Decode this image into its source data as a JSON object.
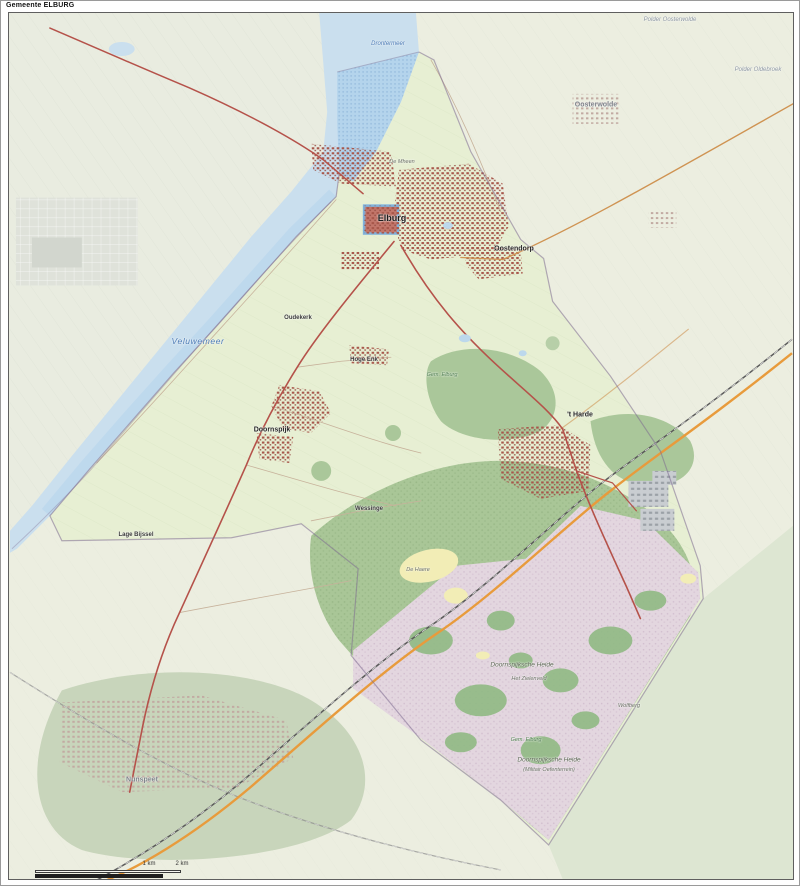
{
  "title": "Gemeente ELBURG",
  "map": {
    "labels": [
      {
        "text": "Elburg",
        "x": 390,
        "y": 216,
        "kind": "city"
      },
      {
        "text": "Oostendorp",
        "x": 512,
        "y": 247,
        "kind": "town"
      },
      {
        "text": "Doornspijk",
        "x": 270,
        "y": 428,
        "kind": "town"
      },
      {
        "text": "'t Harde",
        "x": 578,
        "y": 413,
        "kind": "town"
      },
      {
        "text": "Hoge Enk",
        "x": 362,
        "y": 358,
        "kind": "town-small"
      },
      {
        "text": "Lage Bijssel",
        "x": 134,
        "y": 533,
        "kind": "town-small"
      },
      {
        "text": "Wessinge",
        "x": 367,
        "y": 507,
        "kind": "town-small"
      },
      {
        "text": "Oudekerk",
        "x": 296,
        "y": 316,
        "kind": "town-small"
      },
      {
        "text": "Nunspeet",
        "x": 140,
        "y": 778,
        "kind": "town-faded"
      },
      {
        "text": "Oosterwolde",
        "x": 594,
        "y": 103,
        "kind": "town-faded"
      },
      {
        "text": "Veluwemeer",
        "x": 196,
        "y": 339,
        "kind": "water-large"
      },
      {
        "text": "Drontermeer",
        "x": 386,
        "y": 42,
        "kind": "water-small"
      },
      {
        "text": "Polder Oosterwolde",
        "x": 668,
        "y": 18,
        "kind": "area-faded"
      },
      {
        "text": "Polder Oldebroek",
        "x": 756,
        "y": 68,
        "kind": "area-faded"
      },
      {
        "text": "Doornspijksche Heide",
        "x": 520,
        "y": 663,
        "kind": "area"
      },
      {
        "text": "Het Zielenveld",
        "x": 527,
        "y": 677,
        "kind": "area-small"
      },
      {
        "text": "Doornspijksche Heide",
        "x": 547,
        "y": 758,
        "kind": "area"
      },
      {
        "text": "(Militair Oefenterrein)",
        "x": 547,
        "y": 768,
        "kind": "area-small"
      },
      {
        "text": "De Haere",
        "x": 416,
        "y": 568,
        "kind": "area-small"
      },
      {
        "text": "De Mheen",
        "x": 400,
        "y": 160,
        "kind": "area-small"
      },
      {
        "text": "Wolfberg",
        "x": 627,
        "y": 704,
        "kind": "area-small"
      },
      {
        "text": "Gem. Elburg",
        "x": 440,
        "y": 373,
        "kind": "gem"
      },
      {
        "text": "Gem. Elburg",
        "x": 524,
        "y": 738,
        "kind": "gem"
      }
    ],
    "scale": {
      "labels": [
        "1 km",
        "2 km"
      ]
    }
  },
  "colors": {
    "water": "#cadfee",
    "water_municipal": "#b4d4ec",
    "land_outside": "#eceee0",
    "land_municipal": "#e7efd3",
    "forest": "#a9c697",
    "forest_faded": "#c8d5bb",
    "heath": "#e3d6df",
    "sand": "#f2edb6",
    "urban": "#a8574b",
    "urban_faded": "#c2aaa2",
    "road_main": "#b5524a",
    "road_secondary": "#cf9352",
    "highway": "#e89b3c",
    "railway": "#5a5a5a",
    "boundary": "#7d6b8f",
    "label_water": "#4a7ab5"
  }
}
